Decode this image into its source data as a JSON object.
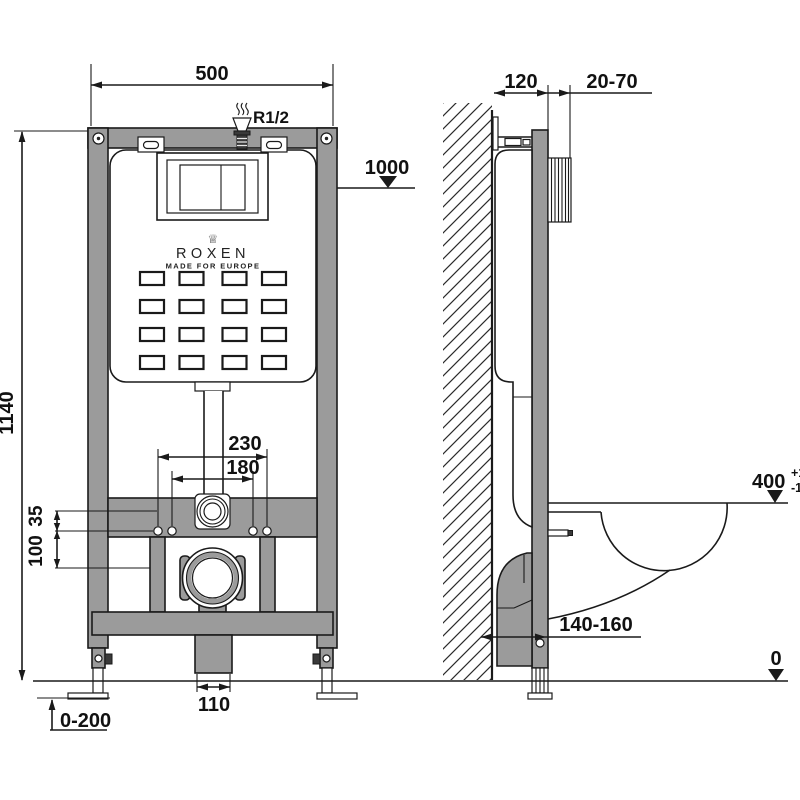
{
  "colors": {
    "frame_gray": "#9b9b9b",
    "line": "#1a1a1a",
    "background": "#ffffff"
  },
  "brand": {
    "crown": "♕",
    "name": "ROXEN",
    "tagline": "MADE FOR EUROPE"
  },
  "front": {
    "width": "500",
    "height": "1140",
    "inlet": "R1/2",
    "marker_1000": "1000",
    "bolt_span_outer": "230",
    "bolt_span_inner": "180",
    "offset_small": "35",
    "offset_large": "100",
    "drain_width": "110",
    "feet_range": "0-200"
  },
  "side": {
    "depth": "120",
    "plate_depth_range": "20-70",
    "bowl_height": "400",
    "bowl_height_tol_plus": "+10",
    "bowl_height_tol_minus": "-10",
    "outlet_range": "140-160",
    "floor_level": "0"
  }
}
